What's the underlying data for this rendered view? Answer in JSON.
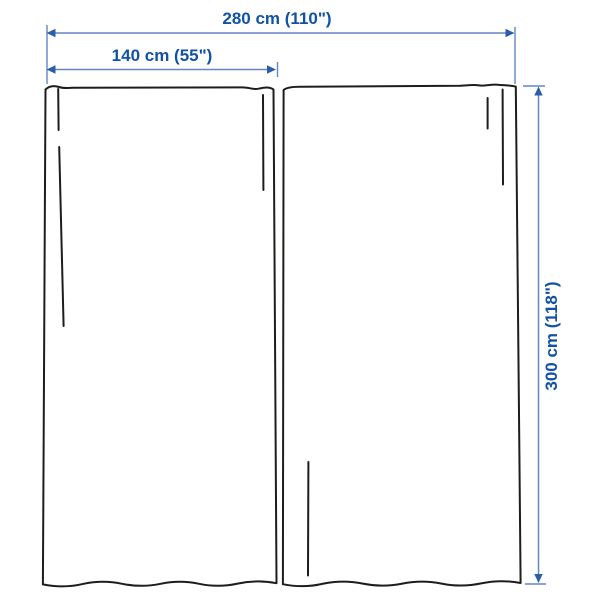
{
  "colors": {
    "background": "#ffffff",
    "ink": "#1d1d1b",
    "dim_line": "#6486c2",
    "dim_arrow": "#2a5dab",
    "dim_text": "#1252a5"
  },
  "dimensions": {
    "total_width_label": "280 cm (110\")",
    "panel_width_label": "140 cm (55\")",
    "height_label": "300 cm (118\")"
  }
}
